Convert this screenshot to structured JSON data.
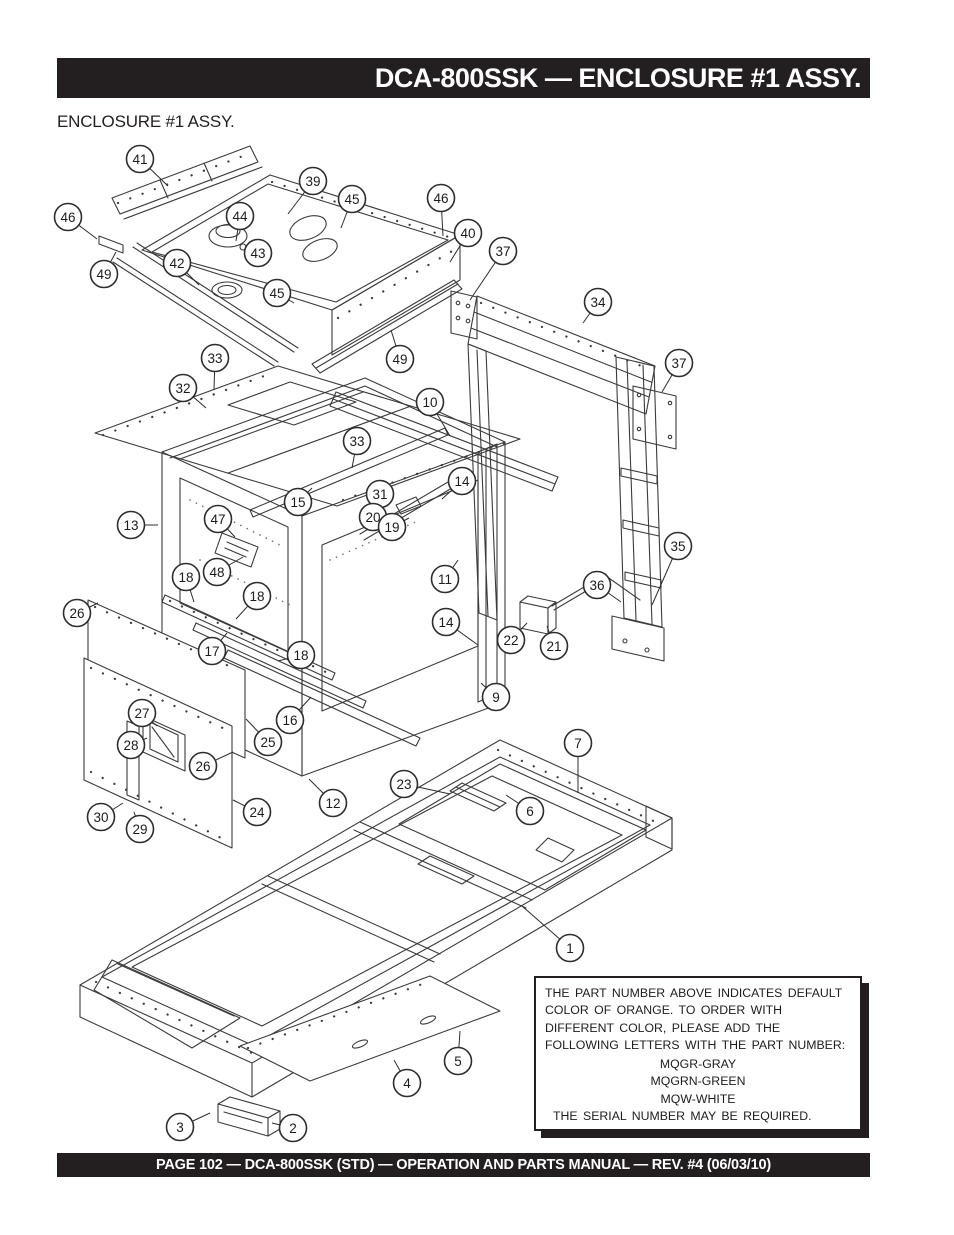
{
  "header": {
    "title": "DCA-800SSK — ENCLOSURE #1 ASSY.",
    "subtitle": "ENCLOSURE #1 ASSY."
  },
  "note": {
    "body": "THE PART NUMBER ABOVE INDICATES DEFAULT COLOR OF ORANGE. TO ORDER WITH DIFFERENT COLOR, PLEASE ADD THE FOLLOWING LETTERS WITH THE PART NUMBER:",
    "colors": [
      "MQGR-GRAY",
      "MQGRN-GREEN",
      "MQW-WHITE"
    ],
    "serial": "THE SERIAL NUMBER MAY BE REQUIRED."
  },
  "footer": {
    "text": "PAGE 102 — DCA-800SSK (STD)  — OPERATION AND PARTS MANUAL — REV. #4  (06/03/10)"
  },
  "diagram": {
    "ink_color": "#3b3b3b",
    "callouts": [
      {
        "n": 41,
        "x": 140,
        "y": 159,
        "tx": 168,
        "ty": 186
      },
      {
        "n": 39,
        "x": 313,
        "y": 181,
        "tx": 288,
        "ty": 214
      },
      {
        "n": 45,
        "x": 352,
        "y": 199,
        "tx": 341,
        "ty": 228
      },
      {
        "n": 46,
        "x": 441,
        "y": 198,
        "tx": 443,
        "ty": 236
      },
      {
        "n": 46,
        "x": 68,
        "y": 217,
        "tx": 97,
        "ty": 239
      },
      {
        "n": 44,
        "x": 240,
        "y": 216,
        "tx": 236,
        "ty": 241
      },
      {
        "n": 40,
        "x": 468,
        "y": 233,
        "tx": 450,
        "ty": 262
      },
      {
        "n": 37,
        "x": 503,
        "y": 251,
        "tx": 470,
        "ty": 300
      },
      {
        "n": 43,
        "x": 258,
        "y": 253,
        "tx": 246,
        "ty": 249
      },
      {
        "n": 42,
        "x": 177,
        "y": 263,
        "tx": 199,
        "ty": 285
      },
      {
        "n": 49,
        "x": 104,
        "y": 274,
        "tx": 116,
        "ty": 252
      },
      {
        "n": 45,
        "x": 277,
        "y": 293,
        "tx": 294,
        "ty": 303
      },
      {
        "n": 34,
        "x": 598,
        "y": 302,
        "tx": 583,
        "ty": 323
      },
      {
        "n": 33,
        "x": 215,
        "y": 358,
        "tx": 214,
        "ty": 390
      },
      {
        "n": 49,
        "x": 400,
        "y": 359,
        "tx": 391,
        "ty": 330
      },
      {
        "n": 37,
        "x": 679,
        "y": 363,
        "tx": 662,
        "ty": 392
      },
      {
        "n": 32,
        "x": 183,
        "y": 388,
        "tx": 206,
        "ty": 408
      },
      {
        "n": 10,
        "x": 430,
        "y": 402,
        "tx": 450,
        "ty": 436
      },
      {
        "n": 33,
        "x": 357,
        "y": 441,
        "tx": 352,
        "ty": 468
      },
      {
        "n": 14,
        "x": 462,
        "y": 481,
        "tx": 442,
        "ty": 499
      },
      {
        "n": 31,
        "x": 380,
        "y": 494,
        "tx": 367,
        "ty": 507
      },
      {
        "n": 15,
        "x": 298,
        "y": 502,
        "tx": 312,
        "ty": 488
      },
      {
        "n": 20,
        "x": 373,
        "y": 517,
        "tx": 392,
        "ty": 520
      },
      {
        "n": 13,
        "x": 131,
        "y": 525,
        "tx": 158,
        "ty": 525
      },
      {
        "n": 19,
        "x": 392,
        "y": 527,
        "tx": 409,
        "ty": 518
      },
      {
        "n": 47,
        "x": 218,
        "y": 519,
        "tx": 235,
        "ty": 537
      },
      {
        "n": 35,
        "x": 678,
        "y": 546,
        "tx": 652,
        "ty": 605
      },
      {
        "n": 48,
        "x": 217,
        "y": 572,
        "tx": 243,
        "ty": 557
      },
      {
        "n": 18,
        "x": 186,
        "y": 577,
        "tx": 194,
        "ty": 602
      },
      {
        "n": 11,
        "x": 445,
        "y": 579,
        "tx": 458,
        "ty": 560
      },
      {
        "n": 36,
        "x": 597,
        "y": 585,
        "tx": 621,
        "ty": 602
      },
      {
        "n": 18,
        "x": 257,
        "y": 596,
        "tx": 236,
        "ty": 619
      },
      {
        "n": 26,
        "x": 77,
        "y": 613,
        "tx": 98,
        "ty": 603
      },
      {
        "n": 14,
        "x": 446,
        "y": 622,
        "tx": 478,
        "ty": 645
      },
      {
        "n": 22,
        "x": 511,
        "y": 640,
        "tx": 527,
        "ty": 623
      },
      {
        "n": 21,
        "x": 554,
        "y": 646,
        "tx": 547,
        "ty": 626
      },
      {
        "n": 17,
        "x": 212,
        "y": 651,
        "tx": 227,
        "ty": 633
      },
      {
        "n": 18,
        "x": 301,
        "y": 655,
        "tx": 278,
        "ty": 661
      },
      {
        "n": 9,
        "x": 496,
        "y": 697,
        "tx": 481,
        "ty": 683
      },
      {
        "n": 27,
        "x": 142,
        "y": 713,
        "tx": 157,
        "ty": 726
      },
      {
        "n": 16,
        "x": 290,
        "y": 720,
        "tx": 311,
        "ty": 697
      },
      {
        "n": 25,
        "x": 268,
        "y": 742,
        "tx": 246,
        "ty": 719
      },
      {
        "n": 7,
        "x": 578,
        "y": 743,
        "tx": 578,
        "ty": 793
      },
      {
        "n": 28,
        "x": 131,
        "y": 745,
        "tx": 147,
        "ty": 738
      },
      {
        "n": 26,
        "x": 203,
        "y": 766,
        "tx": 233,
        "ty": 752
      },
      {
        "n": 12,
        "x": 333,
        "y": 803,
        "tx": 309,
        "ty": 779
      },
      {
        "n": 24,
        "x": 257,
        "y": 812,
        "tx": 233,
        "ty": 800
      },
      {
        "n": 6,
        "x": 530,
        "y": 811,
        "tx": 506,
        "ty": 795
      },
      {
        "n": 30,
        "x": 101,
        "y": 817,
        "tx": 123,
        "ty": 803
      },
      {
        "n": 29,
        "x": 140,
        "y": 829,
        "tx": 134,
        "ty": 812
      },
      {
        "n": 1,
        "x": 570,
        "y": 948,
        "tx": 522,
        "ty": 906
      },
      {
        "n": 23,
        "x": 404,
        "y": 784,
        "tx": 450,
        "ty": 794
      },
      {
        "n": 5,
        "x": 458,
        "y": 1061,
        "tx": 460,
        "ty": 1031
      },
      {
        "n": 4,
        "x": 407,
        "y": 1083,
        "tx": 394,
        "ty": 1060
      },
      {
        "n": 3,
        "x": 180,
        "y": 1127,
        "tx": 210,
        "ty": 1113
      },
      {
        "n": 2,
        "x": 293,
        "y": 1128,
        "tx": 272,
        "ty": 1123
      }
    ]
  }
}
